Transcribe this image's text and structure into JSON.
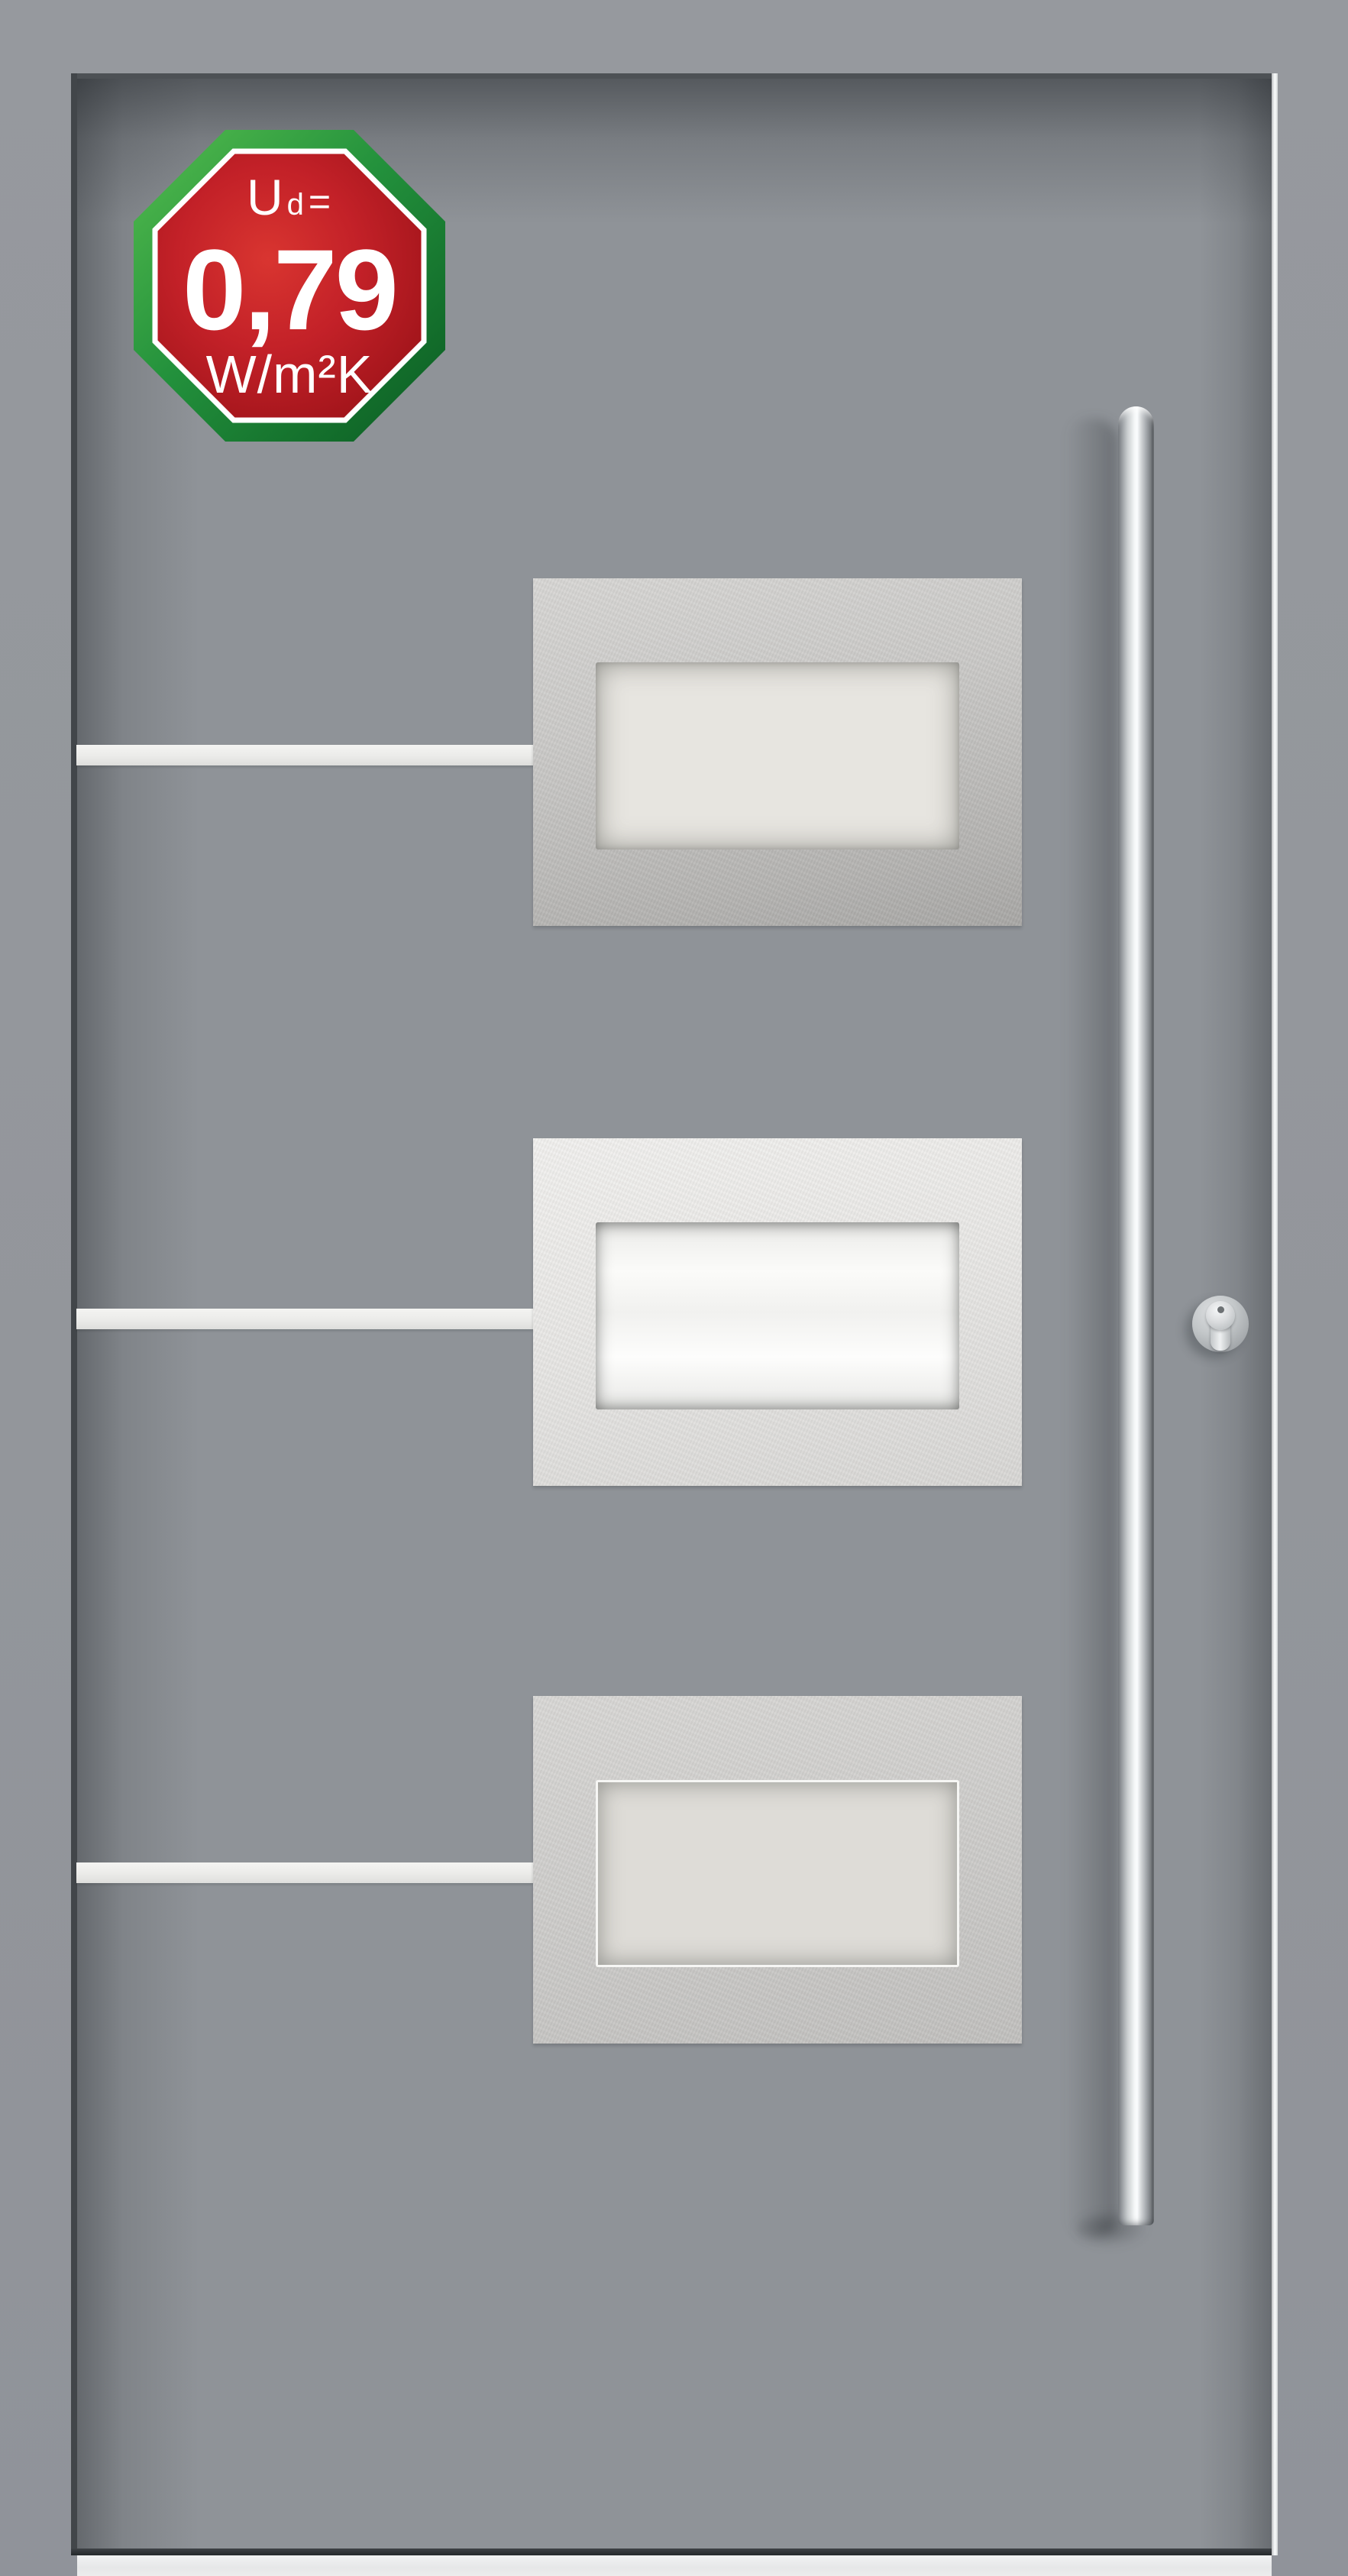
{
  "meta": {
    "description": "Product photo of a grey aluminium entry door with three stainless-steel glazing panels, horizontal inox stripes, vertical bar pull handle, profile lock cylinder and a thermal-insulation value badge"
  },
  "badge": {
    "symbol": "U",
    "symbol_subscript": "d",
    "equals": "=",
    "value": "0,79",
    "unit": "W/m²K",
    "text_color": "#ffffff",
    "ring_color": "#ffffff",
    "green_light": "#4fbb4d",
    "green_mid": "#23913c",
    "green_dark": "#0a5a22",
    "red_center": "#d93530",
    "red_mid": "#c32128",
    "red_edge": "#991117"
  },
  "door": {
    "wall_color": "#94979c",
    "leaf_color": "#8f9398",
    "edge_gap_color": "#42464a",
    "edge_highlight_color": "#f0f2f3",
    "threshold_color": "#e9eaeb",
    "stripe_color": "#eeeeec",
    "stripes_count": 3,
    "panels_count": 3,
    "panel_steel_light": "#f2f1ef",
    "panel_steel_dark": "#a8a7a5",
    "glass_color": "#e7e5e0",
    "glass_bright": "#fbfbf9",
    "handle_color": "#f3f5f6",
    "lock_color": "#c3c7c9"
  }
}
